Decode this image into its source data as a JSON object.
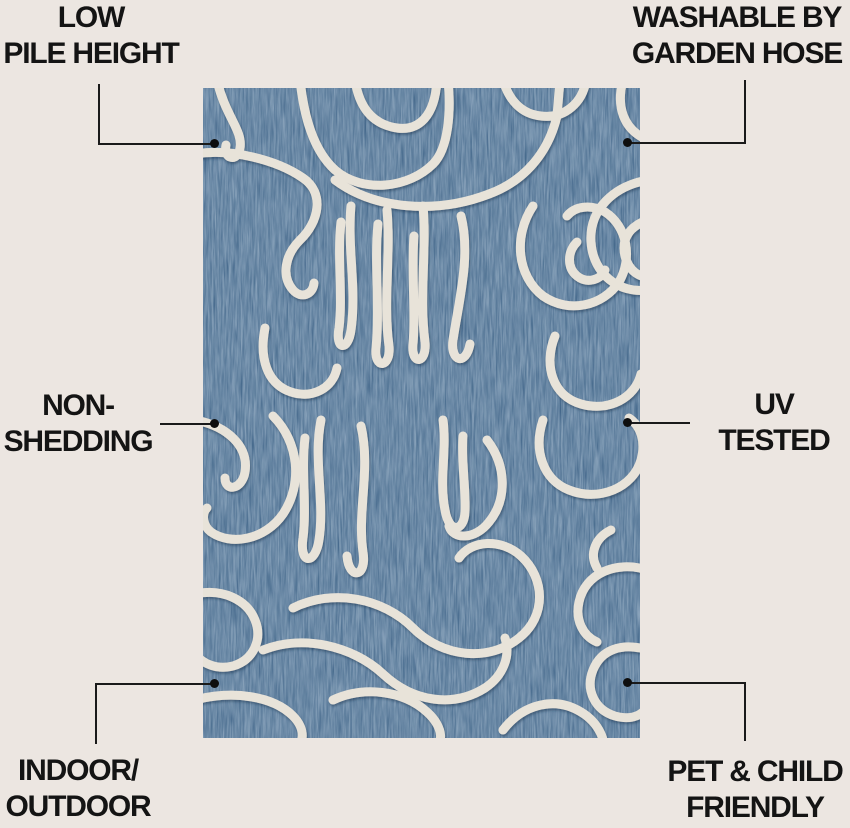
{
  "page": {
    "background_color": "#ECE6E1",
    "description": "Rug feature callout infographic"
  },
  "rug": {
    "name": "blue-abstract-squiggle-rug",
    "base_color": "#3D6186",
    "pattern_color": "#E8E3D9"
  },
  "colors": {
    "label_text": "#141414",
    "connector_line": "#1a1a1a",
    "connector_dot": "#0e0e0e"
  },
  "features": [
    {
      "id": "low-pile-height",
      "line1": "LOW",
      "line2": "PILE HEIGHT"
    },
    {
      "id": "washable",
      "line1": "WASHABLE BY",
      "line2": "GARDEN HOSE"
    },
    {
      "id": "non-shedding",
      "line1": "NON-",
      "line2": "SHEDDING"
    },
    {
      "id": "uv-tested",
      "line1": "UV",
      "line2": "TESTED"
    },
    {
      "id": "indoor-outdoor",
      "line1": "INDOOR/",
      "line2": "OUTDOOR"
    },
    {
      "id": "pet-child-friendly",
      "line1": "PET & CHILD",
      "line2": "FRIENDLY"
    }
  ]
}
